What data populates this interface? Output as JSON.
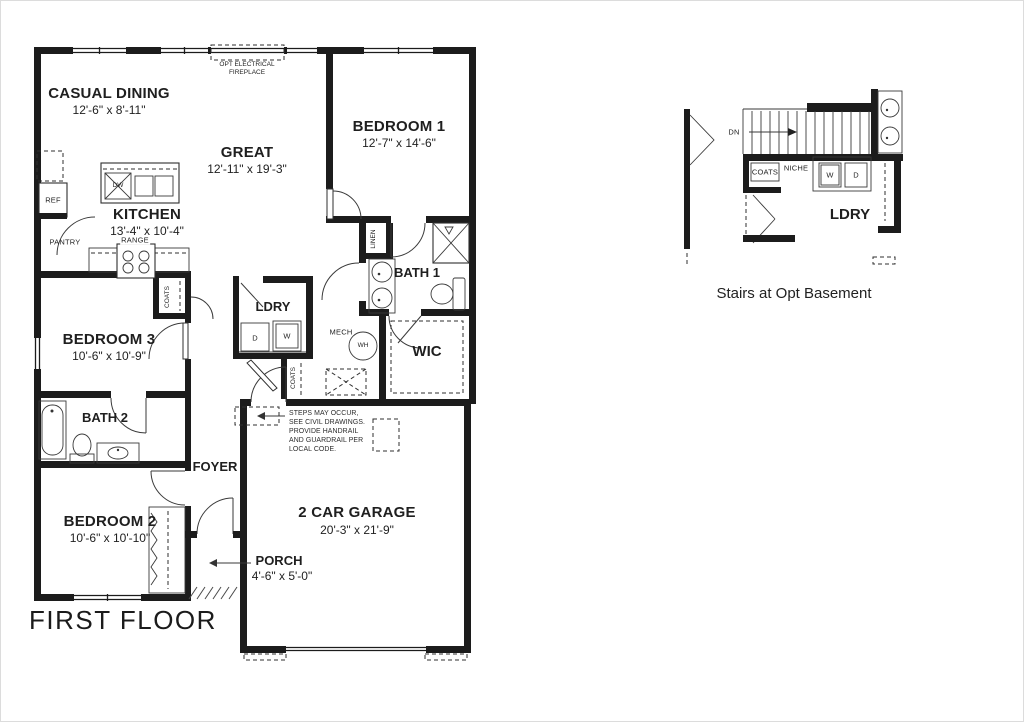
{
  "title": "FIRST FLOOR",
  "rooms": {
    "casual_dining": {
      "name": "CASUAL DINING",
      "dims": "12'-6\" x 8'-11\""
    },
    "great": {
      "name": "GREAT",
      "dims": "12'-11\" x 19'-3\""
    },
    "bedroom1": {
      "name": "BEDROOM 1",
      "dims": "12'-7\" x 14'-6\""
    },
    "kitchen": {
      "name": "KITCHEN",
      "dims": "13'-4\" x 10'-4\""
    },
    "bath1": {
      "name": "BATH 1"
    },
    "bedroom3": {
      "name": "BEDROOM 3",
      "dims": "10'-6\" x 10'-9\""
    },
    "ldry": {
      "name": "LDRY"
    },
    "mech": {
      "name": "MECH"
    },
    "wic": {
      "name": "WIC"
    },
    "bath2": {
      "name": "BATH 2"
    },
    "foyer": {
      "name": "FOYER"
    },
    "bedroom2": {
      "name": "BEDROOM 2",
      "dims": "10'-6\" x 10'-10\""
    },
    "garage": {
      "name": "2 CAR GARAGE",
      "dims": "20'-3\" x 21'-9\""
    },
    "porch": {
      "name": "PORCH",
      "dims": "4'-6\" x 5'-0\""
    }
  },
  "fixtures": {
    "ref": "REF",
    "pantry": "PANTRY",
    "range": "RANGE",
    "dw": "DW",
    "linen": "LINEN",
    "coats_hall": "COATS",
    "coats_foyer": "COATS",
    "dryer": "D",
    "washer": "W",
    "water_heater": "WH",
    "fireplace": "OPT ELECTRICAL\nFIREPLACE"
  },
  "notes": {
    "steps": "STEPS MAY OCCUR,\nSEE CIVIL DRAWINGS.\nPROVIDE HANDRAIL\nAND GUARDRAIL PER\nLOCAL CODE."
  },
  "stairs_detail": {
    "dn": "DN",
    "coats": "COATS",
    "niche": "NICHE",
    "washer": "W",
    "dryer": "D",
    "ldry": "LDRY",
    "caption": "Stairs at Opt Basement"
  },
  "colors": {
    "wall": "#1c1c1c",
    "line": "#2f2f2f",
    "background": "#ffffff"
  }
}
